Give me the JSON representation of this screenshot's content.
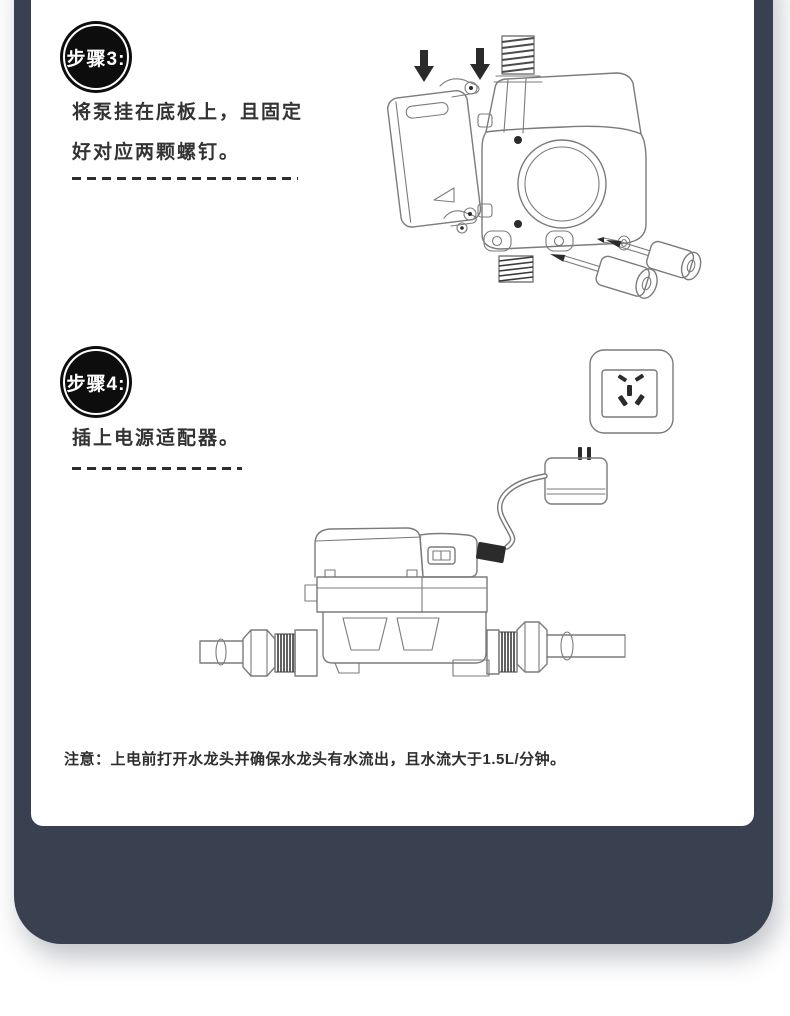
{
  "steps": [
    {
      "badge": "步骤3:",
      "lines": [
        "将泵挂在底板上，且固定",
        "好对应两颗螺钉。"
      ],
      "illustration": "pump-hung-on-baseplate-with-two-screws"
    },
    {
      "badge": "步骤4:",
      "lines": [
        "插上电源适配器。"
      ],
      "illustration": "power-adapter-outlet-and-pump-installed-on-pipe"
    }
  ],
  "note": {
    "text": "注意：上电前打开水龙头并确保水龙头有水流出，且水流大于1.5L/分钟。"
  },
  "colors": {
    "frame": "#394050",
    "badge_bg": "#0d0d0d",
    "badge_text": "#ffffff",
    "body_text": "#333333",
    "line_art": "#7b7b7b"
  },
  "icons": {
    "down_arrow": "solid black arrow pointing down",
    "power_outlet": "five-hole wall socket",
    "power_adapter": "plug adapter with two prongs"
  }
}
